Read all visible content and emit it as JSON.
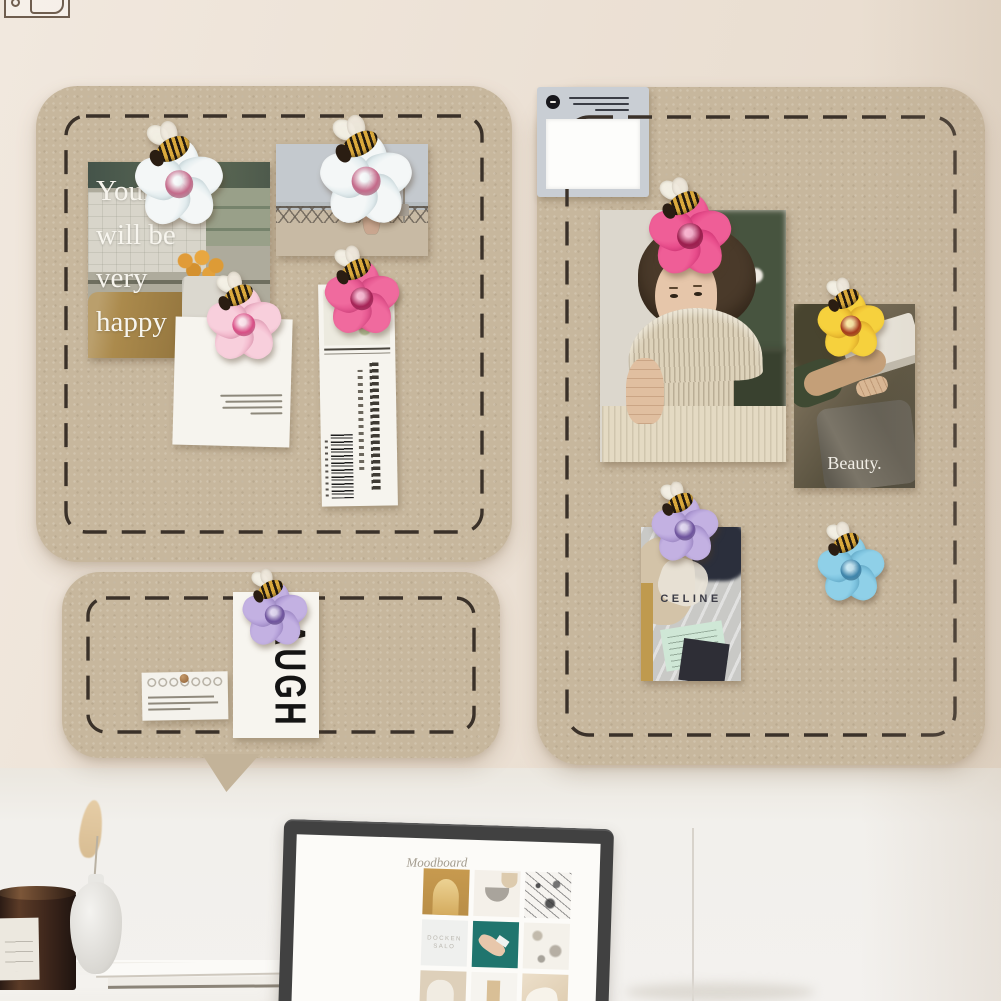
{
  "boards": {
    "left": {
      "kitchen_photo_quote_lines": [
        "Your life",
        "will be",
        "very",
        "happy"
      ]
    },
    "right": {
      "beauty_caption": "Beauty.",
      "celine_brand": "CELINE"
    },
    "bottom": {
      "laugh_card_text": "LAUGH"
    }
  },
  "desk": {
    "moodboard": {
      "title": "Moodboard",
      "docken_tile_lines": [
        "DOCKEN",
        "SALO"
      ]
    }
  },
  "pins": [
    {
      "name": "flower-bee-pin-white",
      "petal_color": "#eef4f5",
      "locations": [
        "kitchen-photo",
        "beach-photo"
      ]
    },
    {
      "name": "flower-bee-pin-lightpink",
      "petal_color": "#f3b8cd",
      "locations": [
        "note-card"
      ]
    },
    {
      "name": "flower-bee-pin-magenta",
      "petal_color": "#ec4f8e",
      "locations": [
        "bookmark",
        "woman-photo"
      ]
    },
    {
      "name": "flower-bee-pin-yellow",
      "petal_color": "#f2c83a",
      "locations": [
        "beauty-photo"
      ]
    },
    {
      "name": "flower-bee-pin-purple",
      "petal_color": "#b9a3dc",
      "locations": [
        "celine-photo",
        "laugh-card"
      ]
    },
    {
      "name": "flower-bee-pin-blue",
      "petal_color": "#7fc3e0",
      "locations": [
        "sticky-note"
      ]
    }
  ],
  "colors": {
    "wall_upper": "#ece1d5",
    "wall_lower": "#f2f0ec",
    "board_felt": "#c7b79d",
    "stitch": "#3a3129",
    "teal_tile": "#20756e",
    "monitor_frame": "#414141",
    "mint_receipt": "#cfe7d6"
  }
}
